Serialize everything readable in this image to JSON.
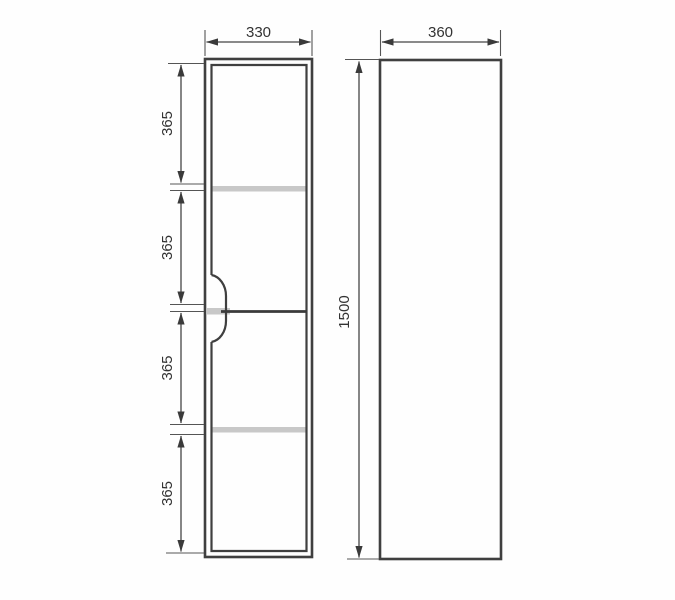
{
  "drawing": {
    "front_view": {
      "width_label": "330",
      "segment_labels": [
        "365",
        "365",
        "365",
        "365"
      ]
    },
    "side_view": {
      "width_label": "360",
      "height_label": "1500"
    }
  },
  "colors": {
    "object_line": "#3f3f3f",
    "divider_line": "#3a3a3a",
    "shelf_fill": "#c8c8c8",
    "notch_fill": "#ffffff",
    "text": "#333333",
    "background": "#fefefe"
  }
}
